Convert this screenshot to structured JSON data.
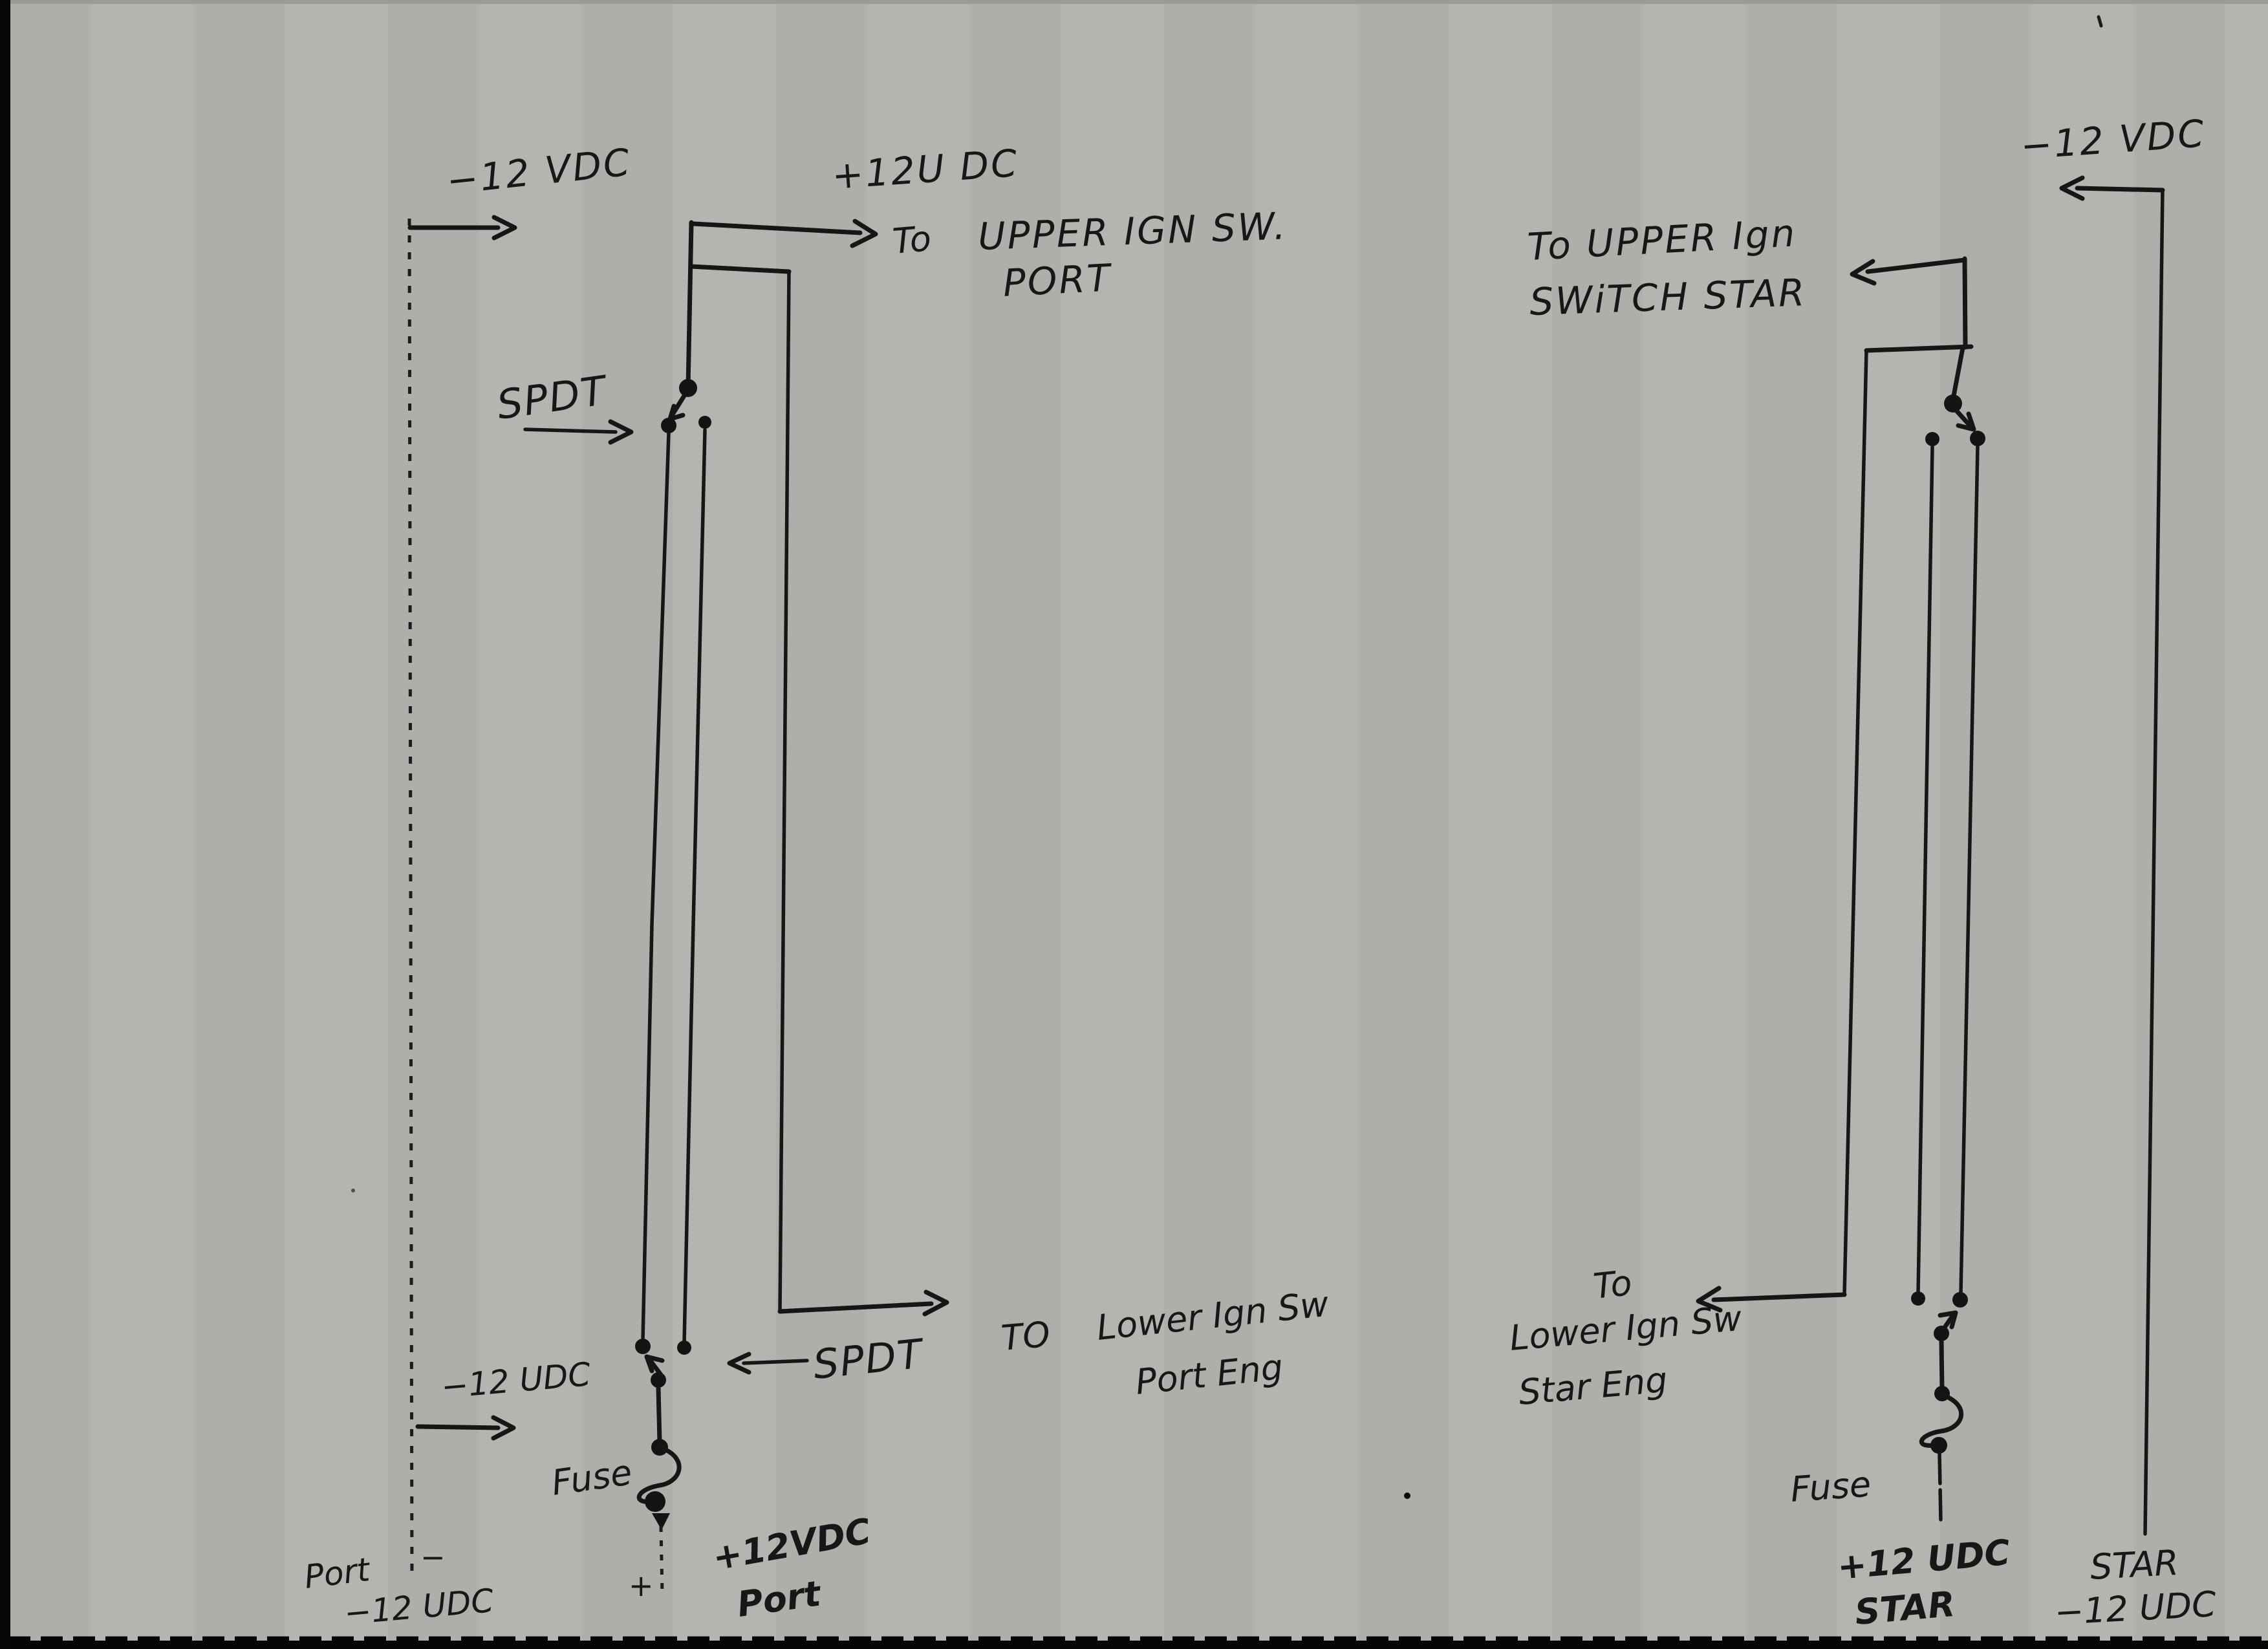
{
  "colors": {
    "paper": "#b2b2af",
    "ink": "#161616",
    "band": "#050505"
  },
  "labels": {
    "port": {
      "neg12_top": "−12 VDC",
      "plus12_top": "+12U DC",
      "to_upper_prefix": "To",
      "to_upper_main": "UPPER IGN SW.",
      "to_upper_sub": "PORT",
      "spdt_upper": "SPDT",
      "neg12_mid": "−12 UDC",
      "to_lower_prefix": "TO",
      "to_lower_line1": "Lower Ign Sw",
      "to_lower_line2": "Port Eng",
      "spdt_lower": "SPDT",
      "fuse": "Fuse",
      "bottom_port": "Port",
      "bottom_minus": "−",
      "bottom_neg12": "−12 UDC",
      "bottom_plus": "+",
      "bottom_plus12": "+12VDC",
      "bottom_port2": "Port"
    },
    "star": {
      "to_upper_line1": "To UPPER Ign",
      "to_upper_line2": "SWiTCH STAR",
      "neg12_top": "−12 VDC",
      "to_lower_prefix": "To",
      "to_lower_line1": "Lower Ign Sw",
      "to_lower_line2": "Star Eng",
      "fuse": "Fuse",
      "plus12_line1": "+12 UDC",
      "plus12_line2": "STAR",
      "bus_label_line1": "STAR",
      "bus_label_line2": "−12 UDC"
    }
  }
}
